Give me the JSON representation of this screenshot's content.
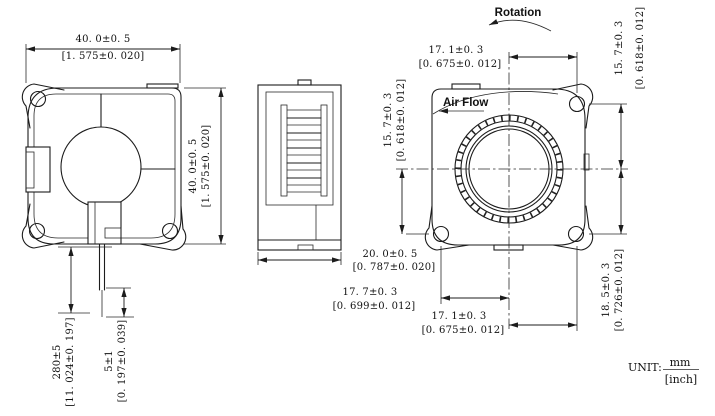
{
  "labels": {
    "rotation": "Rotation",
    "air_flow": "Air Flow"
  },
  "unit": {
    "label": "UNIT:",
    "numerator": "mm",
    "denominator": "[inch]"
  },
  "dimensions": {
    "front_width": {
      "mm": "40. 0±0. 5",
      "inch": "[1. 575±0. 020]"
    },
    "front_height": {
      "mm": "40. 0±0. 5",
      "inch": "[1. 575±0. 020]"
    },
    "lead_wire_length": {
      "mm": "280±5",
      "inch": "[11. 024±0. 197]"
    },
    "lead_wire_tin": {
      "mm": "5±1",
      "inch": "[0. 197±0. 039]"
    },
    "side_depth": {
      "mm": "20. 0±0. 5",
      "inch": "[0. 787±0. 020]"
    },
    "rear_hole_top_x": {
      "mm": "17. 1±0. 3",
      "inch": "[0. 675±0. 012]"
    },
    "rear_hole_top_y": {
      "mm": "15. 7±0. 3",
      "inch": "[0. 618±0. 012]"
    },
    "rear_hole_left_y": {
      "mm": "15. 7±0. 3",
      "inch": "[0. 618±0. 012]"
    },
    "rear_hole_right_y": {
      "mm": "18. 5±0. 3",
      "inch": "[0. 726±0. 012]"
    },
    "rear_hole_bottom_left_x": {
      "mm": "17. 7±0. 3",
      "inch": "[0. 699±0. 012]"
    },
    "rear_hole_bottom_right_x": {
      "mm": "17. 1±0. 3",
      "inch": "[0. 675±0. 012]"
    }
  }
}
